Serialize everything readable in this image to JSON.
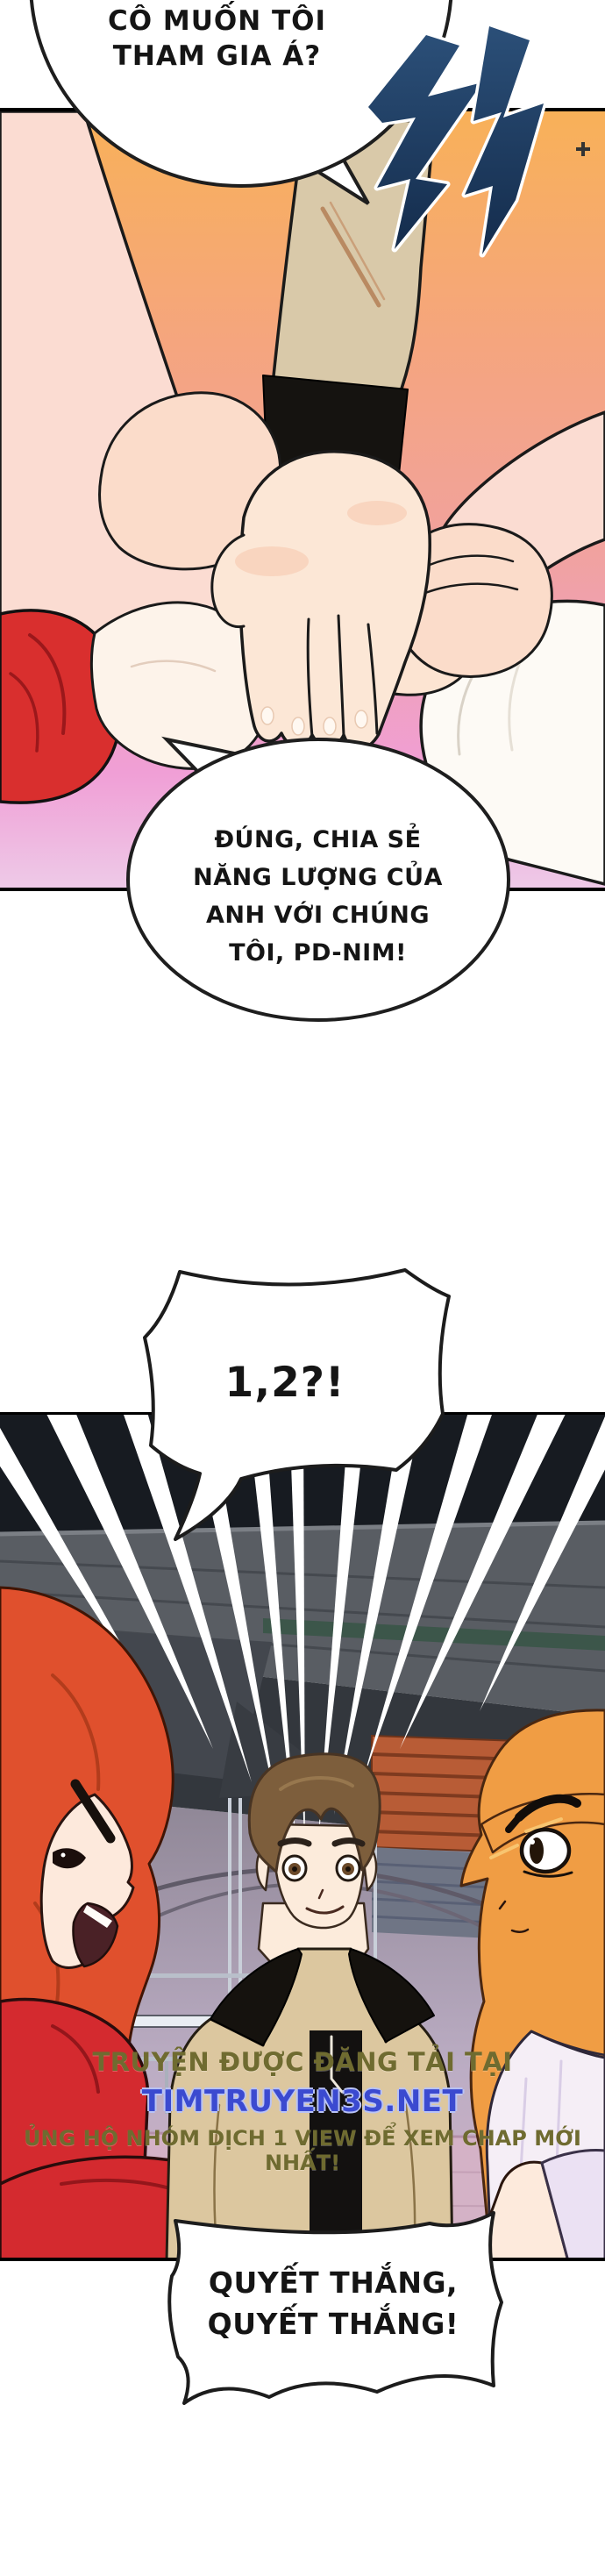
{
  "bubbles": {
    "top": {
      "lines": [
        "CÔ MUỐN TÔI",
        "THAM GIA Á?"
      ]
    },
    "reply": {
      "lines": [
        "ĐÚNG, CHIA SẺ",
        "NĂNG LƯỢNG CỦA",
        "ANH VỚI CHÚNG",
        "TÔI, PD-NIM!"
      ]
    },
    "count": {
      "text": "1,2?!"
    },
    "cheer": {
      "lines": [
        "QUYẾT THẮNG,",
        "QUYẾT THẮNG!"
      ]
    }
  },
  "sfx": {
    "korean": "척"
  },
  "watermark": {
    "line1": "TRUYỆN ĐƯỢC ĐĂNG TẢI TẠI",
    "site": "TIMTRUYEN3S.NET",
    "line2": "ỦNG HỘ NHÓM DỊCH 1 VIEW ĐỂ XEM CHAP MỚI NHẤT!"
  },
  "colors": {
    "watermark_text": "#6f6b30",
    "watermark_site": "#3b4ad0",
    "sfx_blue": "#24466b",
    "panel_orange": "#f8b158",
    "panel_pink": "#f09fd6",
    "sleeve_red": "#d92f2e",
    "sleeve_tan": "#d9c9a9",
    "hair_red": "#e0502d",
    "hair_brown": "#7d5e3c",
    "hair_orange": "#f09d44",
    "arena_dark": "#171b21",
    "bleacher_orange": "#b85c36"
  }
}
